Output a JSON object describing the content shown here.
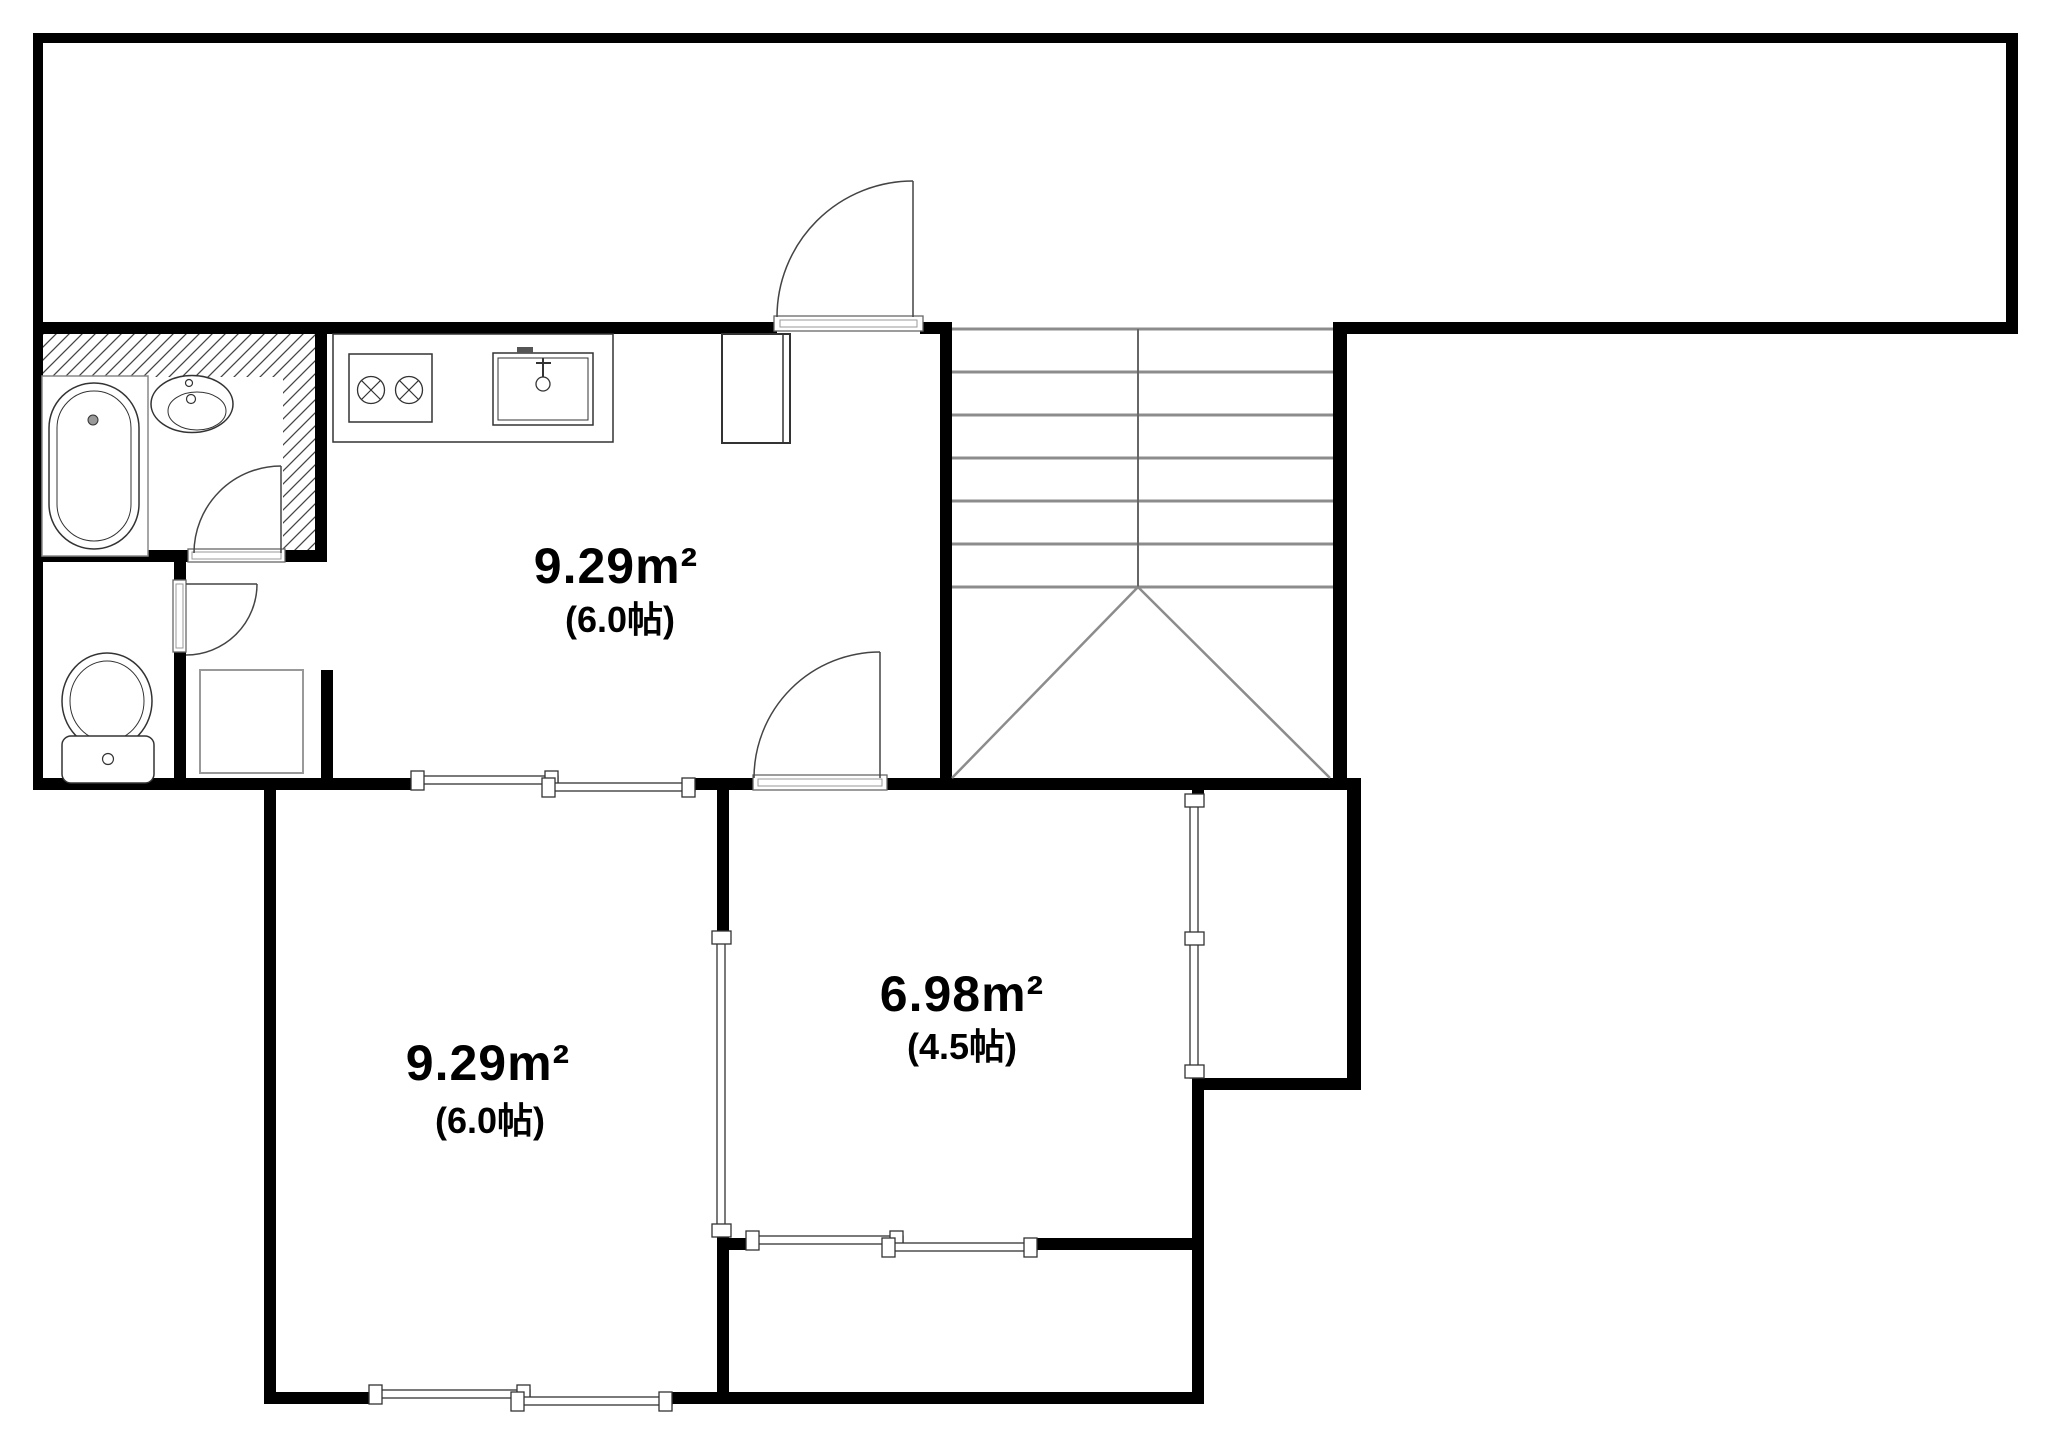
{
  "plan": {
    "title": "apartment-floor-plan",
    "colors": {
      "background": "#ffffff",
      "wall": "#000000",
      "stair_line": "#8c8c8c",
      "fixture_line": "#333333",
      "hatch_line": "#444444"
    },
    "rooms": [
      {
        "id": "kitchen-room",
        "area": "9.29m²",
        "tatami": "(6.0帖)"
      },
      {
        "id": "lower-left-room",
        "area": "9.29m²",
        "tatami": "(6.0帖)"
      },
      {
        "id": "lower-right-room",
        "area": "6.98m²",
        "tatami": "(4.5帖)"
      }
    ],
    "fixtures": [
      "bathtub-icon",
      "washbasin-icon",
      "toilet-icon",
      "washing-machine-pan-icon",
      "two-burner-stove-icon",
      "kitchen-sink-icon",
      "entrance-storage-icon",
      "staircase-icon",
      "swing-door-icon",
      "sliding-window-icon"
    ]
  }
}
